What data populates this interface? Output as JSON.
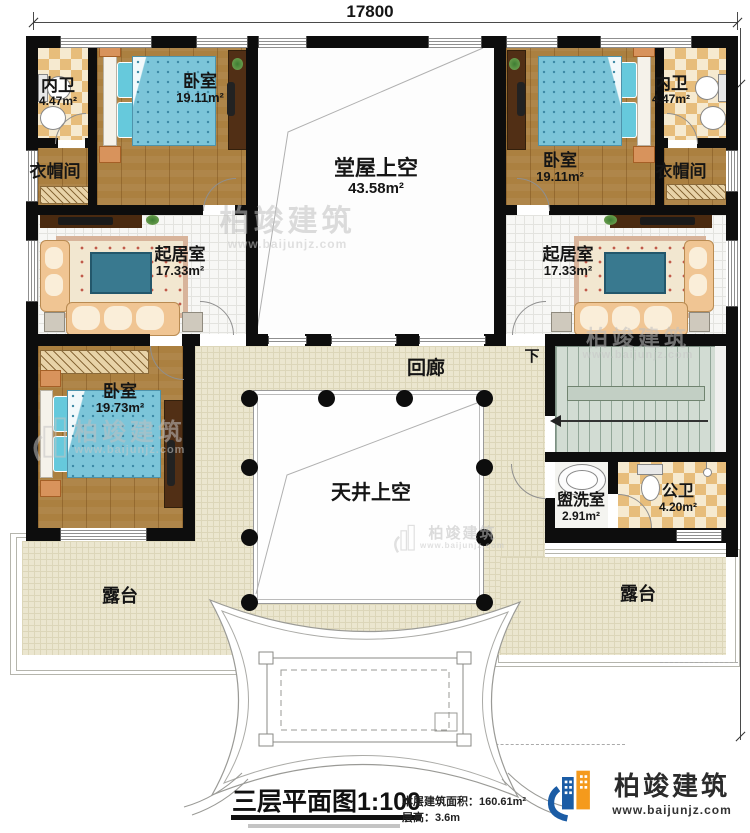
{
  "plan": {
    "dimensions": {
      "width_label": "17800",
      "height_label": "18000"
    },
    "rooms": {
      "neiwei_left": {
        "name": "内卫",
        "area": "4.47m²"
      },
      "bedroom_top_left": {
        "name": "卧室",
        "area": "19.11m²"
      },
      "cloakroom_left": {
        "name": "衣帽间"
      },
      "hall_void": {
        "name": "堂屋上空",
        "area": "43.58m²"
      },
      "bedroom_top_right": {
        "name": "卧室",
        "area": "19.11m²"
      },
      "neiwei_right": {
        "name": "内卫",
        "area": "4.47m²"
      },
      "cloakroom_right": {
        "name": "衣帽间"
      },
      "living_left": {
        "name": "起居室",
        "area": "17.33m²"
      },
      "living_right": {
        "name": "起居室",
        "area": "17.33m²"
      },
      "bedroom_bottom_left": {
        "name": "卧室",
        "area": "19.73m²"
      },
      "corridor": {
        "name": "回廊"
      },
      "courtyard_void": {
        "name": "天井上空"
      },
      "washroom": {
        "name": "盥洗室",
        "area": "2.91m²"
      },
      "public_bath": {
        "name": "公卫",
        "area": "4.20m²"
      },
      "terrace_left": {
        "name": "露台"
      },
      "terrace_right": {
        "name": "露台"
      }
    },
    "stairs_label": "下"
  },
  "title_block": {
    "title": "三层平面图",
    "scale": "1:100",
    "area_label": "本层建筑面积：",
    "area_value": "160.61m²",
    "floor_height_label": "层高：",
    "floor_height_value": "3.6m"
  },
  "brand": {
    "name": "柏竣建筑",
    "website": "www.baijunjz.com"
  },
  "watermark": {
    "text": "柏竣建筑",
    "website": "www.baijunjz.com"
  },
  "colors": {
    "wall": "#0d0d0d",
    "wood_floor": "#ab8040",
    "bath_checker": "#e7bd7b",
    "corridor_floor": "#ebe6cf",
    "bed": "#7cc5d9",
    "stairs": "#d2dcd3",
    "logo_blue": "#1b5ca5",
    "logo_orange": "#f59a1c"
  }
}
